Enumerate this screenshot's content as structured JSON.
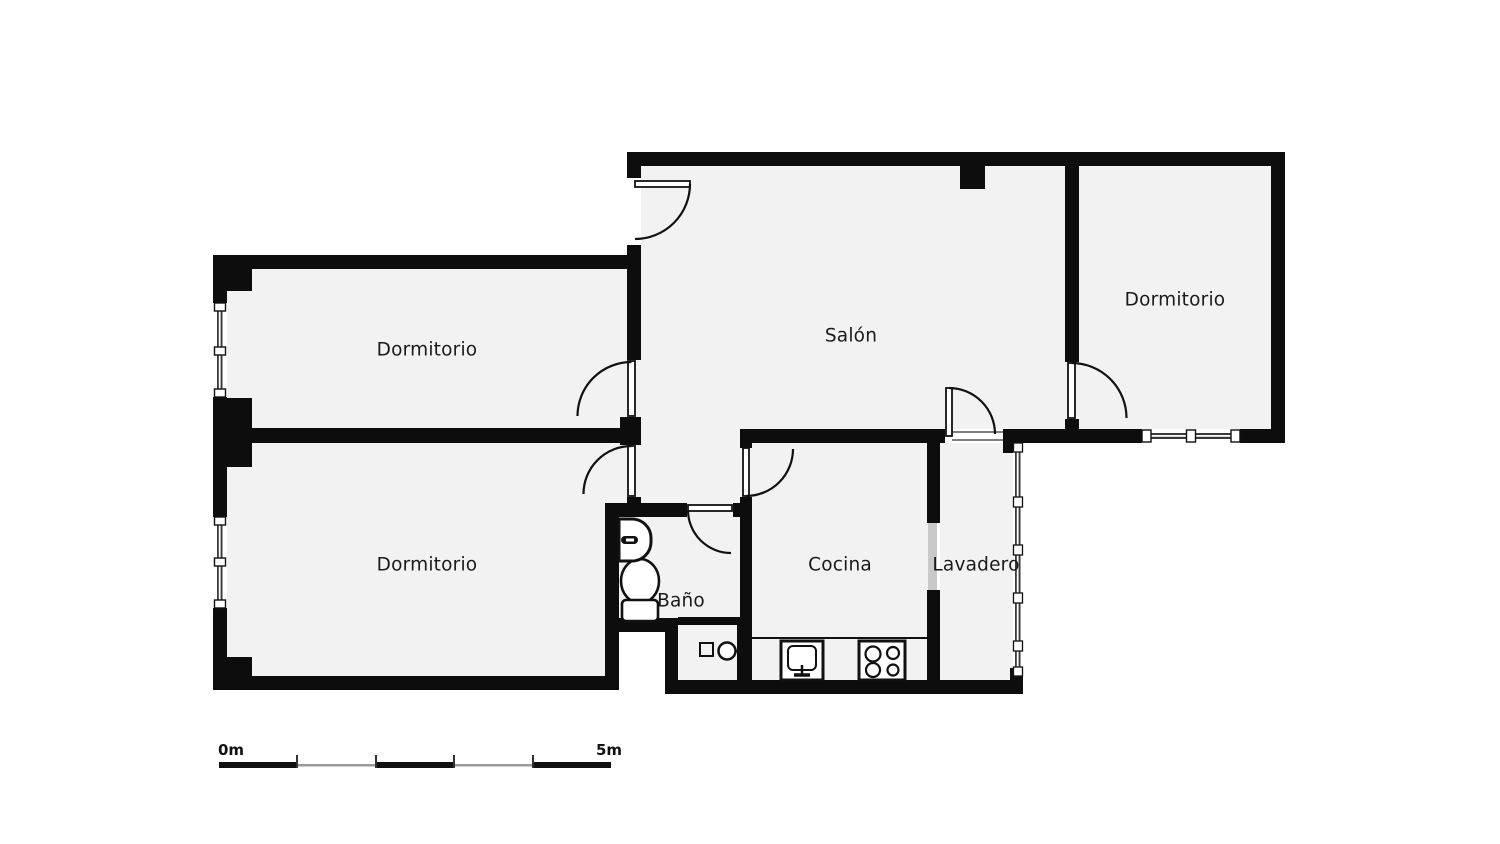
{
  "plan": {
    "type": "apartment-floor-plan",
    "rooms": [
      {
        "key": "dormitorio-top-left",
        "label": "Dormitorio"
      },
      {
        "key": "dormitorio-bottom-left",
        "label": "Dormitorio"
      },
      {
        "key": "salon",
        "label": "Salón"
      },
      {
        "key": "dormitorio-right",
        "label": "Dormitorio"
      },
      {
        "key": "bano",
        "label": "Baño"
      },
      {
        "key": "cocina",
        "label": "Cocina"
      },
      {
        "key": "lavadero",
        "label": "Lavadero"
      }
    ],
    "fixtures": [
      "toilet-icon",
      "bathroom-sink-icon",
      "shower-tray-icon",
      "kitchen-sink-icon",
      "stove-burners-icon",
      "kitchen-counter"
    ],
    "scale_bar": {
      "start_label": "0m",
      "end_label": "5m",
      "total_meters": 5,
      "segments": 5
    },
    "colors": {
      "wall": "#0d0d0d",
      "room_fill": "#f2f2f2",
      "background": "#ffffff",
      "glazing": "#3a3a3a",
      "sliding_door_fill": "#c9c9c9",
      "text": "#1a1a1a",
      "scale_thin_segment": "#9a9a9a"
    }
  }
}
